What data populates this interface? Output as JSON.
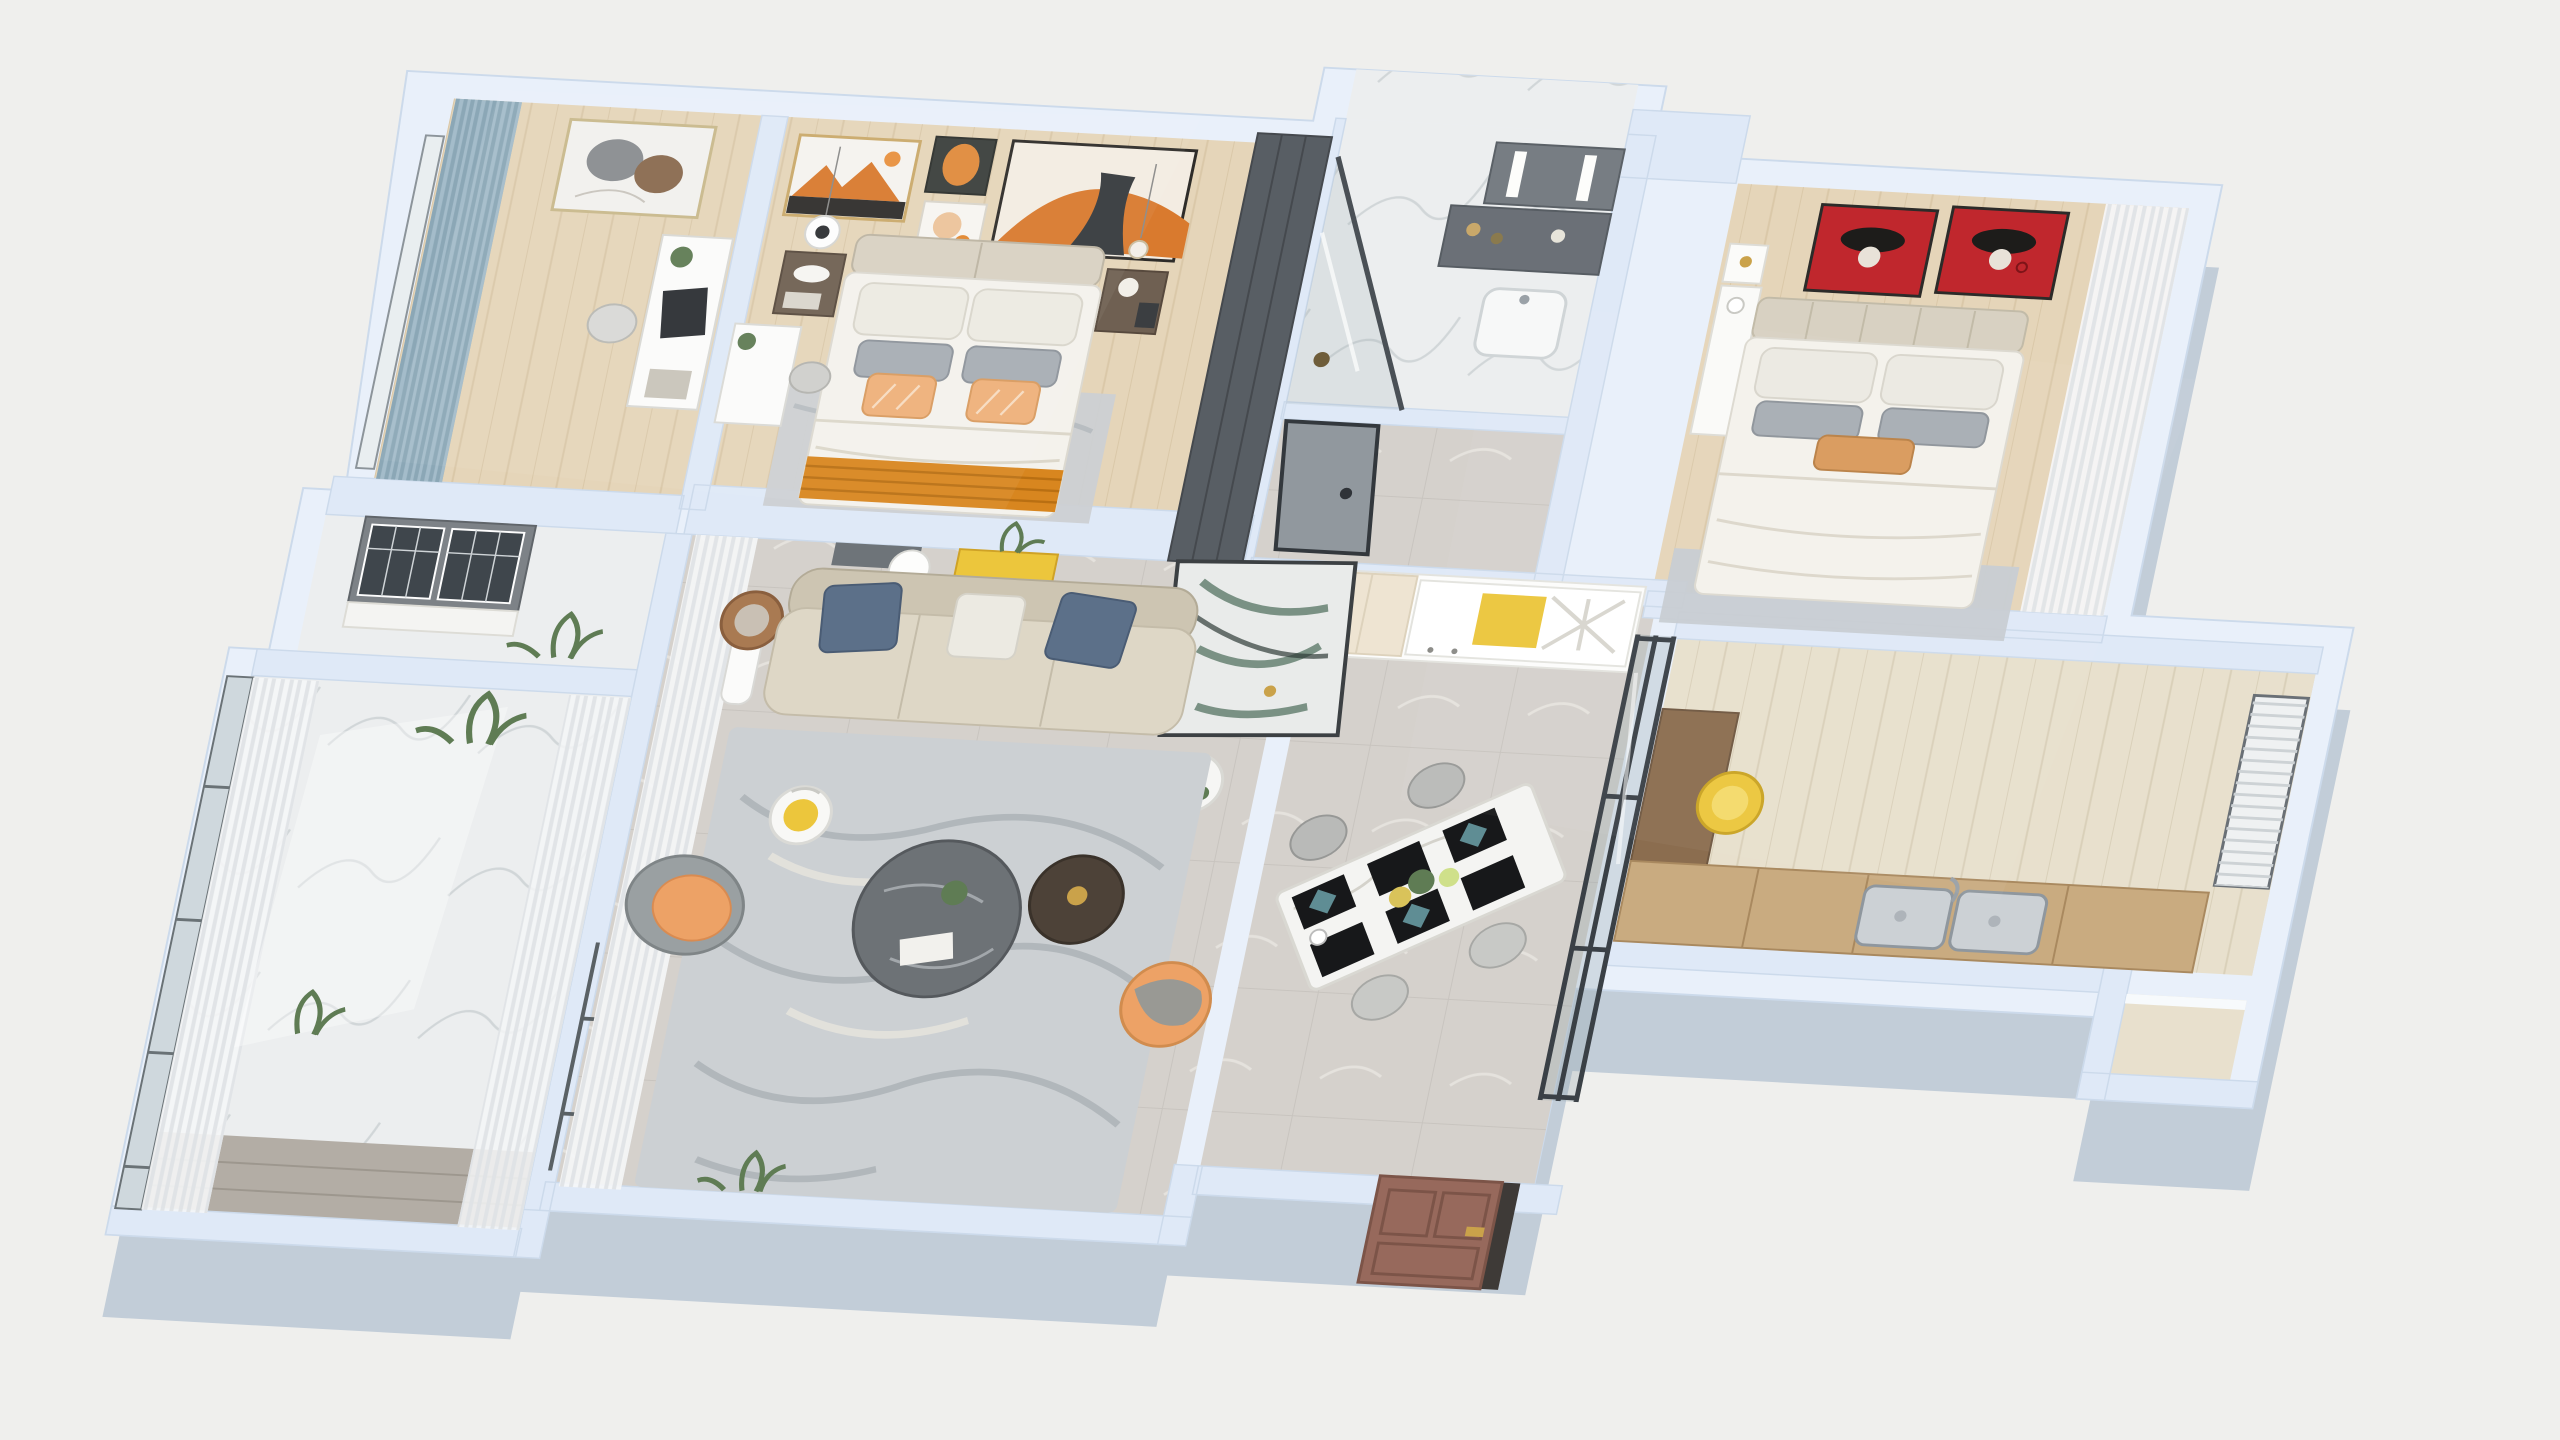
{
  "scene": {
    "type": "3d-isometric-floorplan-render",
    "description": "Dollhouse cutaway render of a three-bedroom apartment viewed from above",
    "rooms": [
      {
        "id": "study-bedroom"
      },
      {
        "id": "master-bedroom"
      },
      {
        "id": "bathroom"
      },
      {
        "id": "hallway"
      },
      {
        "id": "bedroom-2"
      },
      {
        "id": "kitchen"
      },
      {
        "id": "dining-area"
      },
      {
        "id": "living-room"
      },
      {
        "id": "laundry-nook"
      },
      {
        "id": "balcony"
      },
      {
        "id": "entry"
      }
    ]
  },
  "colors": {
    "background": "#efefed",
    "wall_top": "#dfe9f7",
    "wall_face": "#e9f0fa",
    "wall_shadow": "#c2cdd8",
    "wood_floor": "#e5d5b9",
    "kitchen_floor": "#e8e0cd",
    "tile_floor": "#d5d1cc",
    "marble_floor": "#eceeef",
    "sofa_seat": "#ded7c6",
    "sofa_back": "#cdc5b2",
    "pillow_blue": "#5c7089",
    "pillow_white": "#eceae2",
    "pillow_gray": "#a7adb4",
    "pillow_orange": "#efb07a",
    "throw_orange": "#d8861f",
    "rug_gray": "#ccd0d3",
    "bedroom_rug": "#c6ccd2",
    "art_red": "#c0272d",
    "art_orange": "#d97a2e",
    "accent_yellow": "#ecc63c",
    "door_brown": "#97695c",
    "door_gray": "#91989e",
    "wardrobe_dark": "#585e64",
    "cabinet_gray": "#7d8287",
    "accent_orange": "#eda266",
    "curtain_blue": "#a4bcca",
    "sheer_white": "#f5f6f7",
    "counter_wood": "#c9ab80",
    "vanity_gray": "#6b7077",
    "sink_steel": "#ccd1d5",
    "mattress_white": "#f4f2ec",
    "headboard_beige": "#d8d1c2",
    "glass_tint": "#8ea0aa",
    "deck_wood": "#b3ada5",
    "plant_green": "#5f7c54",
    "table_marble": "#f4f4f2",
    "placemat_black": "#17181a",
    "napkin_teal": "#5f8d94",
    "gold": "#caa24a"
  }
}
